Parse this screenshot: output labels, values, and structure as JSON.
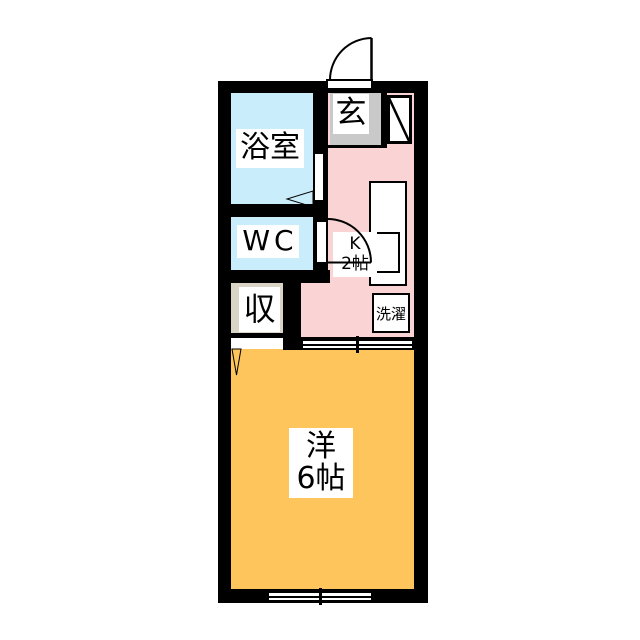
{
  "title": "apartment-floor-plan",
  "colors": {
    "wall": "#000000",
    "background": "#ffffff",
    "bathroom": "#c9edfa",
    "wc": "#c9edfa",
    "closet": "#d9d4c6",
    "entrance": "#c9c9c9",
    "kitchen": "#fad3d5",
    "western_room": "#fdc55c",
    "fixture_fill": "#ffffff"
  },
  "rooms": {
    "bathroom": {
      "label": "浴室"
    },
    "wc": {
      "label": "WC"
    },
    "closet": {
      "label": "収"
    },
    "entrance": {
      "label": "玄"
    },
    "kitchen": {
      "label_line1": "K",
      "label_line2": "2帖"
    },
    "laundry": {
      "label": "洗濯"
    },
    "western_room": {
      "label_line1": "洋",
      "label_line2": "6帖"
    }
  },
  "icons": {
    "entrance_door": "hinged-door-arc",
    "wc_door": "hinged-door-arc",
    "bathroom_door": "door-leaf-wedge",
    "closet_door": "door-leaf-wedge",
    "shoe_cabinet": "cabinet-with-diagonal",
    "kitchen_counter": "counter-with-sink",
    "room_divider": "double-sliding-door",
    "bottom_window": "double-sliding-window"
  }
}
